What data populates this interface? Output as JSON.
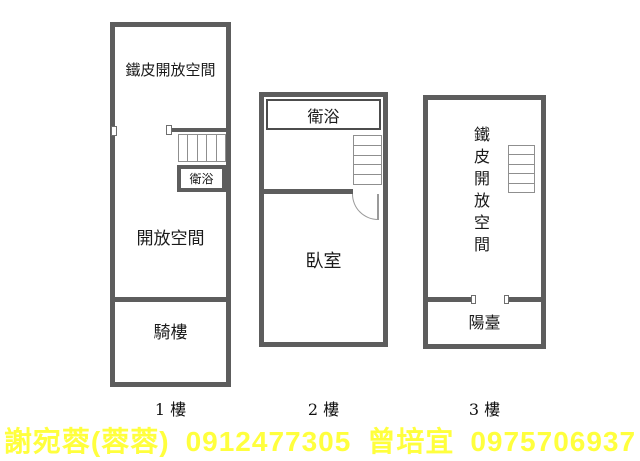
{
  "floors": [
    {
      "caption": "1 樓",
      "labels": {
        "top": "鐵皮開放空間",
        "bath": "衛浴",
        "open": "開放空間",
        "arcade": "騎樓"
      }
    },
    {
      "caption": "2 樓",
      "labels": {
        "bath": "衛浴",
        "bedroom": "臥室"
      }
    },
    {
      "caption": "3 樓",
      "labels": {
        "open_vertical": "鐵皮開放空間",
        "balcony": "陽臺"
      }
    }
  ],
  "contact": {
    "agent1_name": "謝宛蓉(蓉蓉)",
    "agent1_phone": "0912477305",
    "agent2_name": "曾培宜",
    "agent2_phone": "0975706937"
  },
  "colors": {
    "wall": "#5d5d5d",
    "stair_line": "#8f8f8f",
    "room_text": "#1a1a1a",
    "contact_text": "#ffff3d",
    "background": "#ffffff"
  }
}
